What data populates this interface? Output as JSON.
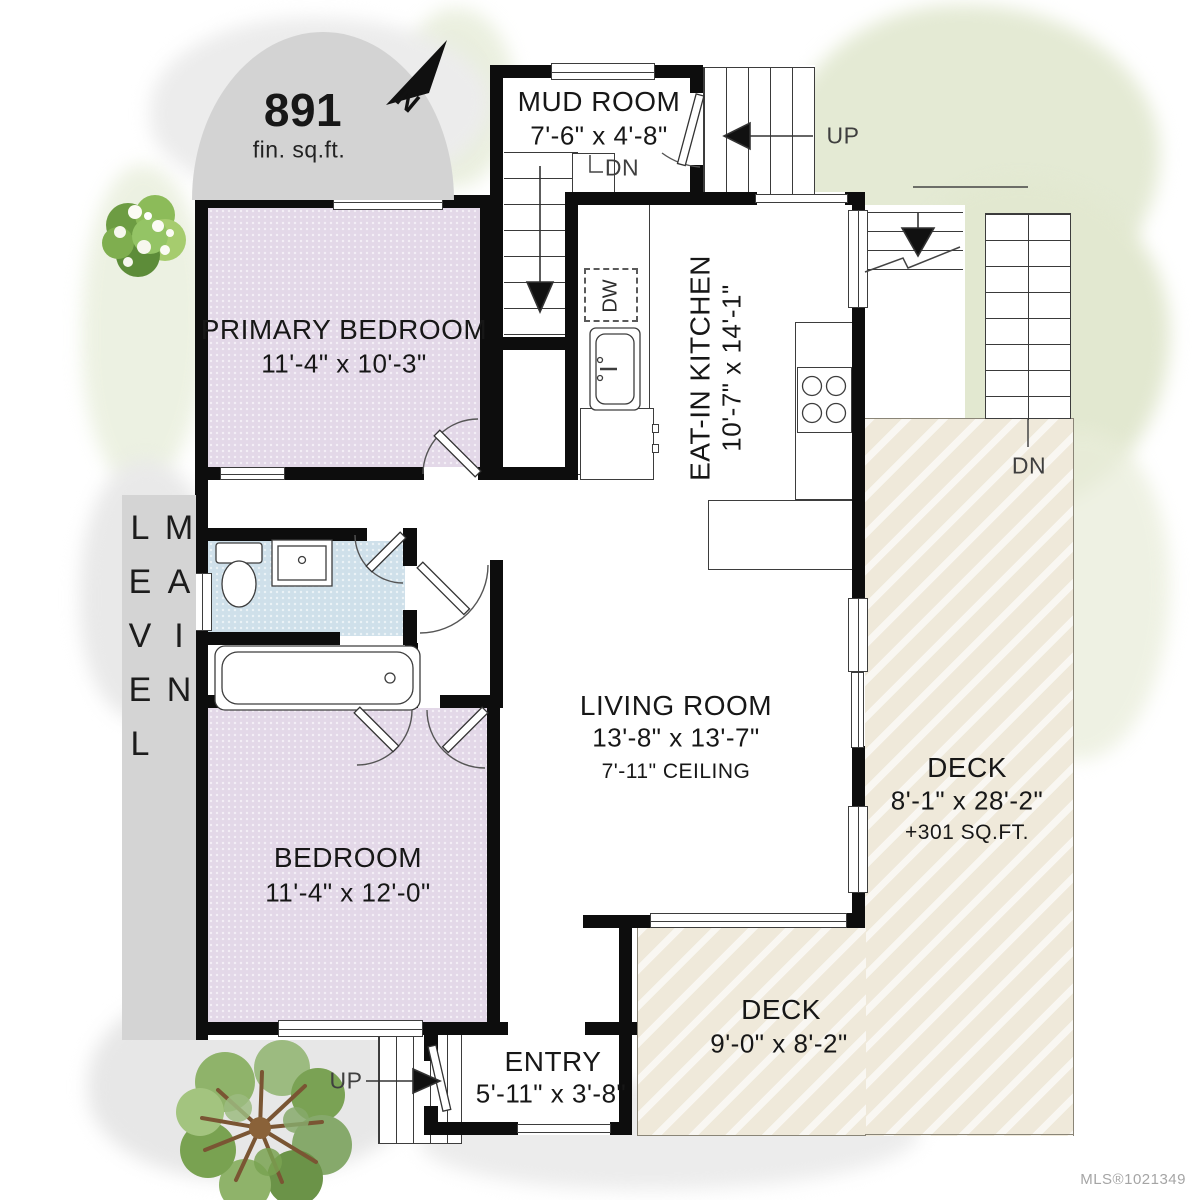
{
  "badge": {
    "area": "891",
    "unit": "fin. sq.ft."
  },
  "compass": {
    "north": "N"
  },
  "level": {
    "label": "MAIN LEVEL"
  },
  "rooms": {
    "mud": {
      "name": "MUD ROOM",
      "dims": "7'-6\" x 4'-8\""
    },
    "primary": {
      "name": "PRIMARY BEDROOM",
      "dims": "11'-4\" x 10'-3\""
    },
    "kitchen": {
      "name": "EAT-IN KITCHEN",
      "dims": "10'-7\" x 14'-1\""
    },
    "living": {
      "name": "LIVING ROOM",
      "dims": "13'-8\" x 13'-7\"",
      "ceiling": "7'-11\" CEILING"
    },
    "bedroom": {
      "name": "BEDROOM",
      "dims": "11'-4\" x 12'-0\""
    },
    "entry": {
      "name": "ENTRY",
      "dims": "5'-11\" x 3'-8\""
    },
    "deck_side": {
      "name": "DECK",
      "dims": "8'-1\" x 28'-2\"",
      "area_note": "+301 SQ.FT."
    },
    "deck_rear": {
      "name": "DECK",
      "dims": "9'-0\" x 8'-2\""
    }
  },
  "stairs": {
    "up_upper": "UP",
    "up_entry": "UP",
    "dn_interior": "DN",
    "dn_deck": "DN"
  },
  "fixtures": {
    "dishwasher": "DW"
  },
  "watermark": "MLS®1021349",
  "colors": {
    "wall": "#0d0d0d",
    "bedroom_fill": "#e3d8e8",
    "bath_fill": "#cfe0ea",
    "deck_fill": "#efe9da",
    "watercolor_green": "#e4ead4",
    "watercolor_gray": "#eaeaea",
    "badge_fill": "#d3d3d3"
  }
}
